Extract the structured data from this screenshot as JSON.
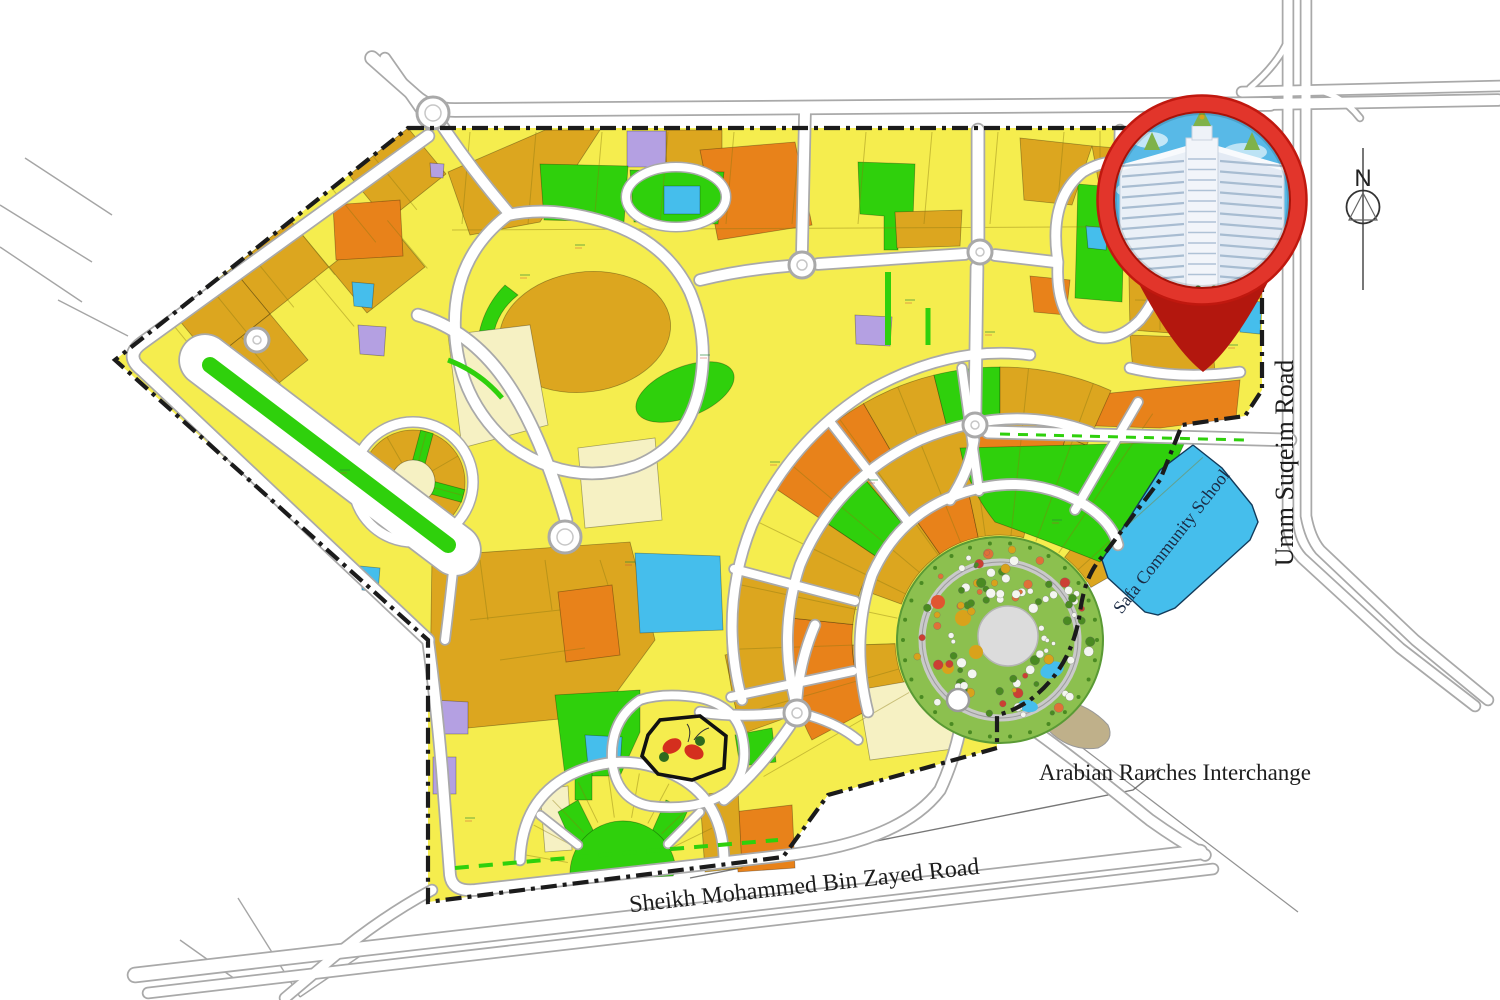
{
  "map": {
    "labels": {
      "sheikh_mohammed_road": "Sheikh Mohammed Bin Zayed Road",
      "arabian_ranches_interchange": "Arabian Ranches Interchange",
      "safa_community_school": "Safa Community School",
      "umm_suqeim_road": "Umm Suqeim Road",
      "compass_north": "N"
    },
    "colors": {
      "parcel_yellow": "#F5ED4E",
      "parcel_gold": "#DCA61F",
      "parcel_orange": "#E8821A",
      "parcel_green": "#2FD00C",
      "parcel_blue": "#45BEEC",
      "parcel_purple": "#B4A0E2",
      "parcel_cream": "#F6F1C3",
      "garden_green": "#8CC04F",
      "road_casing": "#A9A9A9",
      "road_fill": "#FFFFFF",
      "boundary": "#1B1B1B",
      "pin_red": "#E2352B",
      "pin_red_dark": "#B3170E",
      "sky_blue": "#58B9E7",
      "building_white": "#F2F5FA",
      "label_text": "#1D1D1D"
    }
  }
}
